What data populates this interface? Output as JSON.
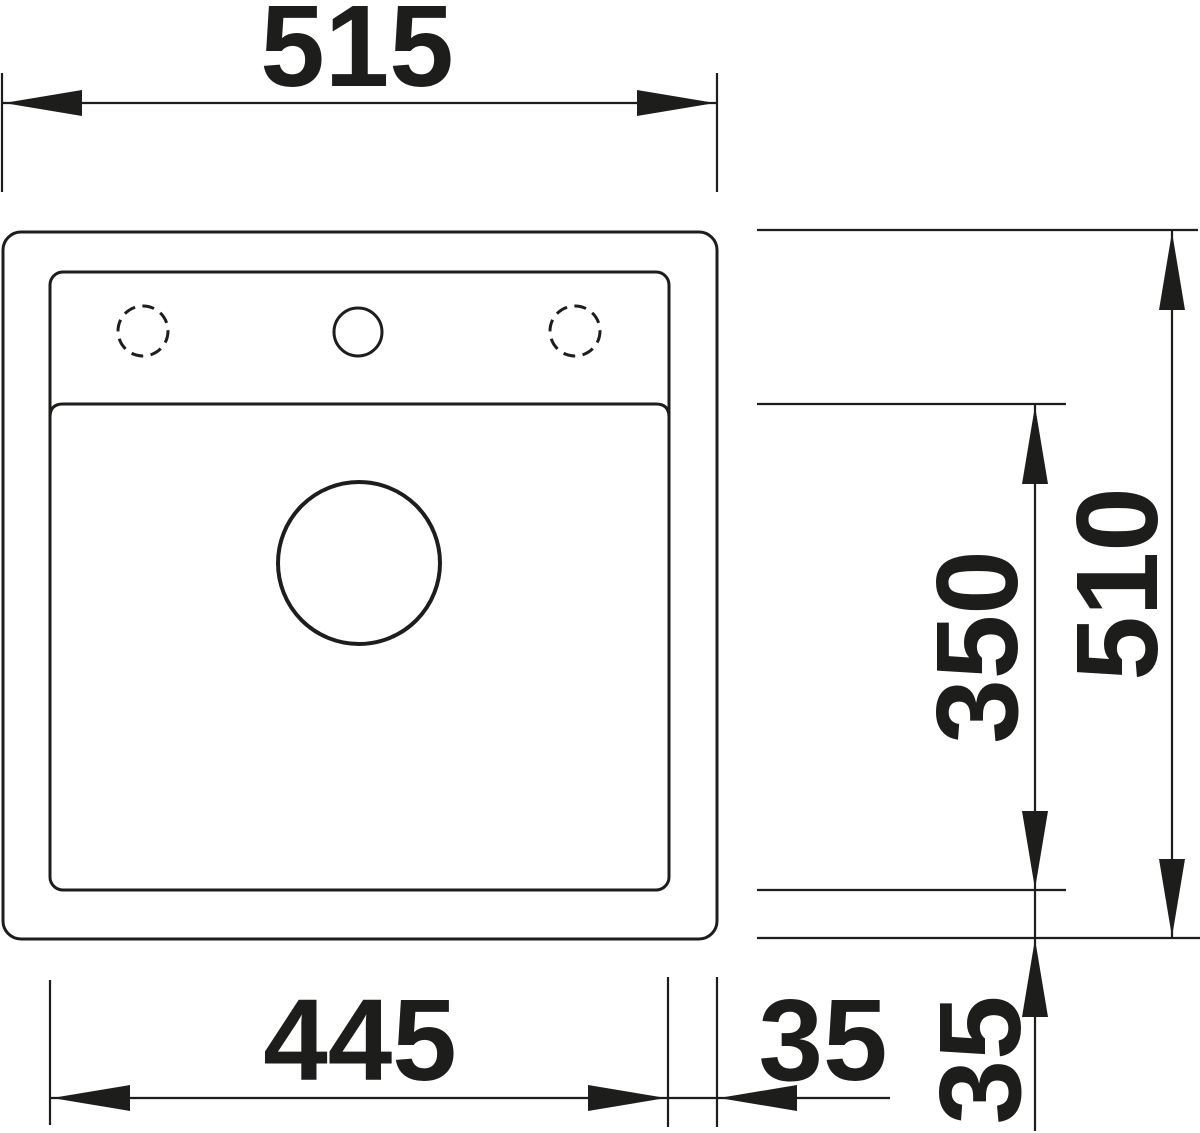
{
  "diagram": {
    "type": "technical-drawing",
    "subject": "kitchen sink top view with installation dimensions",
    "dimension_labels": {
      "overall_width": "515",
      "overall_depth": "510",
      "bowl_width": "445",
      "bowl_depth": "350",
      "offset_right": "35",
      "offset_bottom": "35"
    },
    "colors": {
      "ink": "#1d1d1b",
      "background": "#ffffff"
    }
  }
}
